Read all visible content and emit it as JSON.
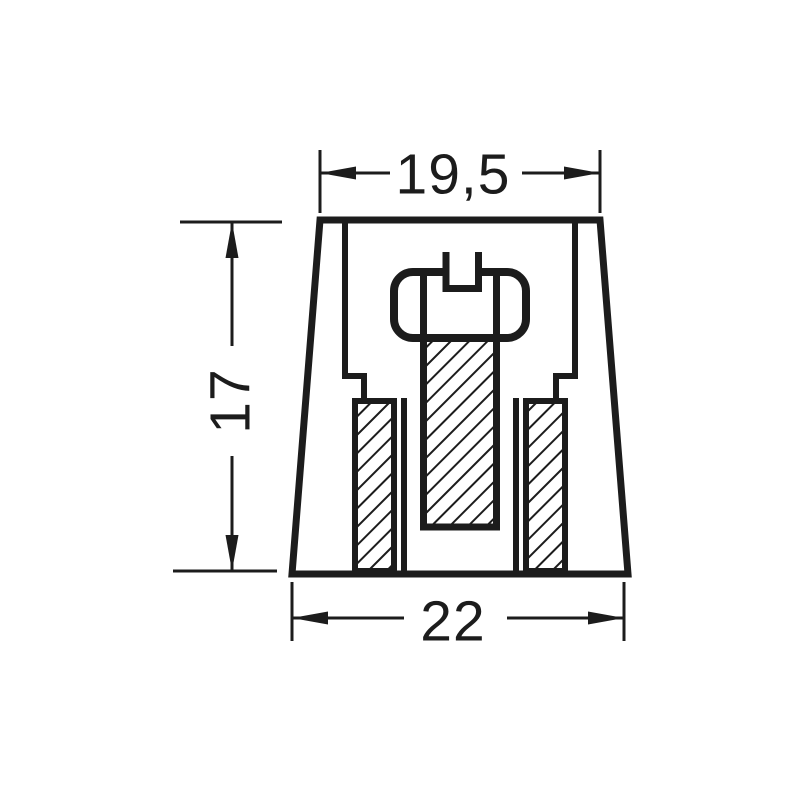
{
  "drawing": {
    "kind": "technical-dimension-drawing",
    "background_color": "#ffffff",
    "line_color": "#1c1c1c",
    "dimensions": {
      "top_width": "19,5",
      "side_height": "17",
      "bottom_width": "22"
    },
    "parts": [
      "knob-body",
      "inner-cavity",
      "slotted-screw",
      "left-insert",
      "right-insert"
    ]
  }
}
